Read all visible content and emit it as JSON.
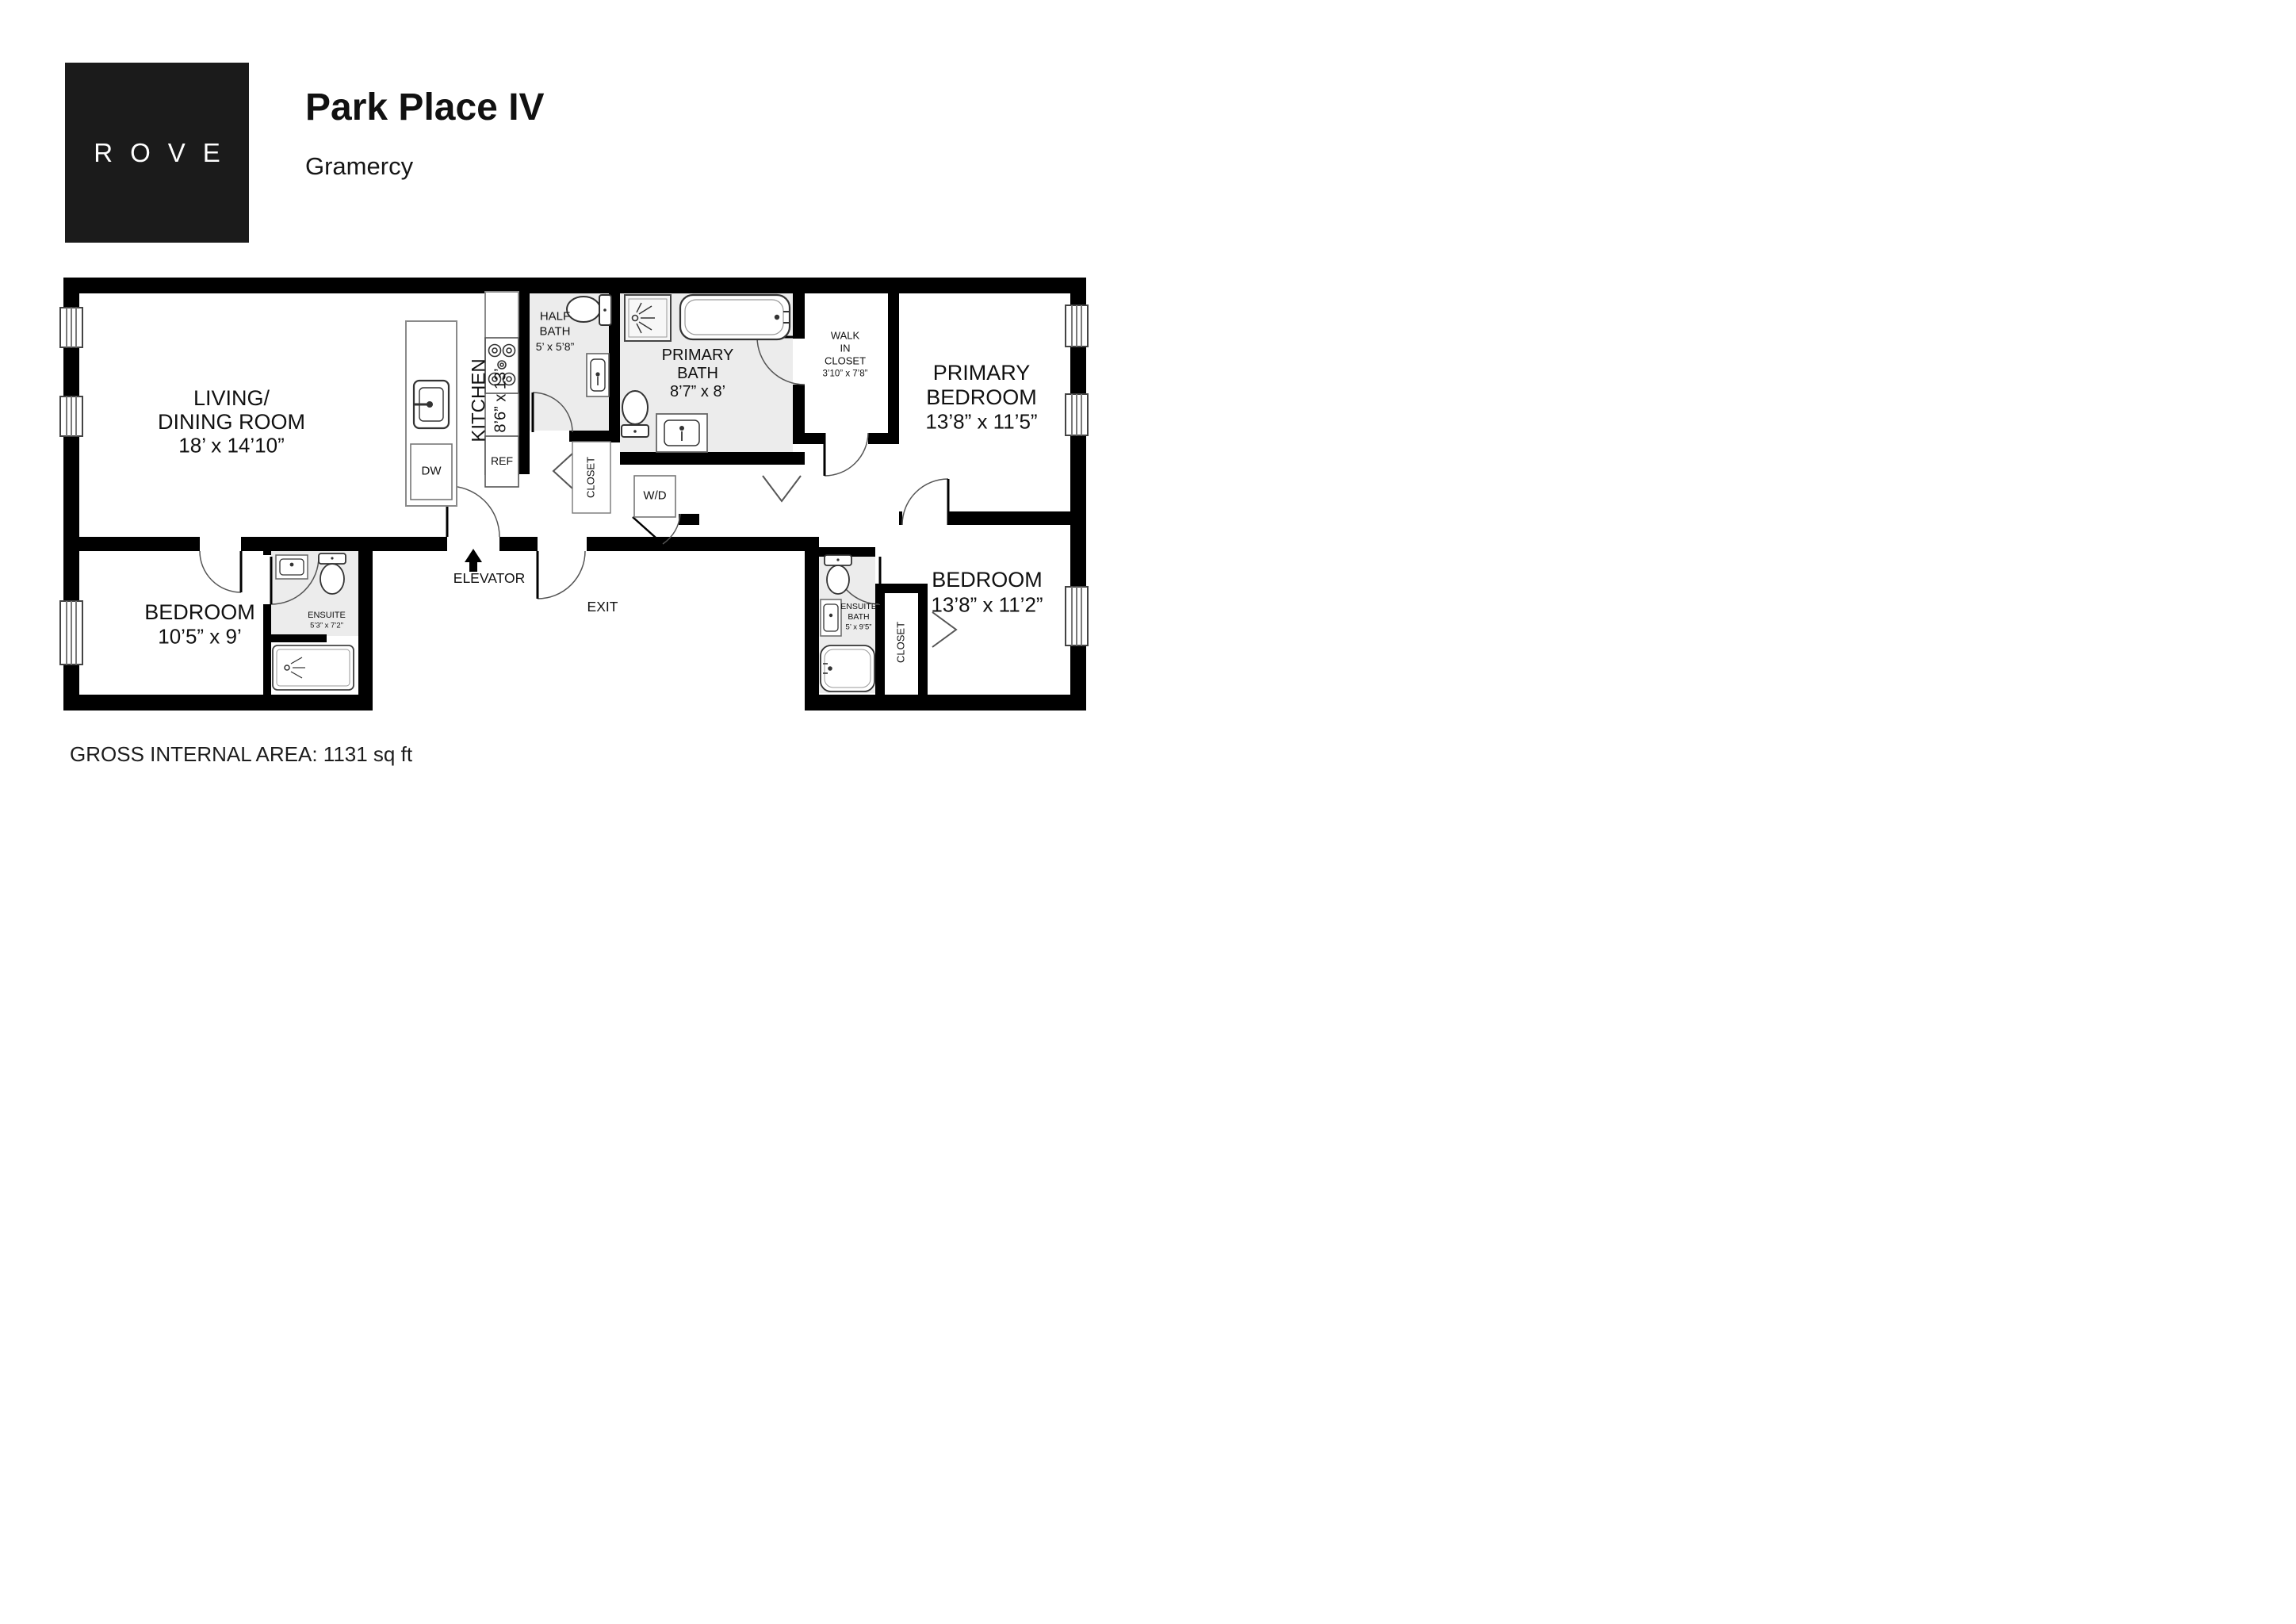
{
  "header": {
    "logo": "ROVE",
    "title": "Park Place IV",
    "subtitle": "Gramercy"
  },
  "footer": {
    "gross_area": "GROSS INTERNAL AREA: 1131 sq ft"
  },
  "plan": {
    "rooms": {
      "living": {
        "line1": "LIVING/",
        "line2": "DINING ROOM",
        "dims": "18’ x 14’10”"
      },
      "kitchen": {
        "name": "KITCHEN",
        "dims": "8’6” x 13’"
      },
      "half_bath": {
        "line1": "HALF",
        "line2": "BATH",
        "dims": "5’ x 5’8”"
      },
      "primary_bath": {
        "line1": "PRIMARY",
        "line2": "BATH",
        "dims": "8’7” x 8’"
      },
      "walk_in_closet": {
        "line1": "WALK",
        "line2": "IN",
        "line3": "CLOSET",
        "dims": "3’10” x 7’8”"
      },
      "primary_bedroom": {
        "line1": "PRIMARY",
        "line2": "BEDROOM",
        "dims": "13’8” x 11’5”"
      },
      "bedroom_left": {
        "line1": "BEDROOM",
        "dims": "10’5” x 9’"
      },
      "ensuite_left": {
        "line1": "ENSUITE",
        "dims": "5’3” x 7’2”"
      },
      "bedroom_right": {
        "line1": "BEDROOM",
        "dims": "13’8” x 11’2”"
      },
      "ensuite_right": {
        "line1": "ENSUITE",
        "line2": "BATH",
        "dims": "5’ x 9’5”"
      },
      "closet_hall": "CLOSET",
      "closet_right": "CLOSET"
    },
    "appliances": {
      "dw": "DW",
      "ref": "REF",
      "wd": "W/D"
    },
    "circulation": {
      "elevator": "ELEVATOR",
      "exit": "EXIT"
    },
    "colors": {
      "wall": "#000000",
      "bath_fill": "#ececec",
      "fixture_stroke": "#333333",
      "counter_stroke": "#8a8a8a"
    }
  }
}
